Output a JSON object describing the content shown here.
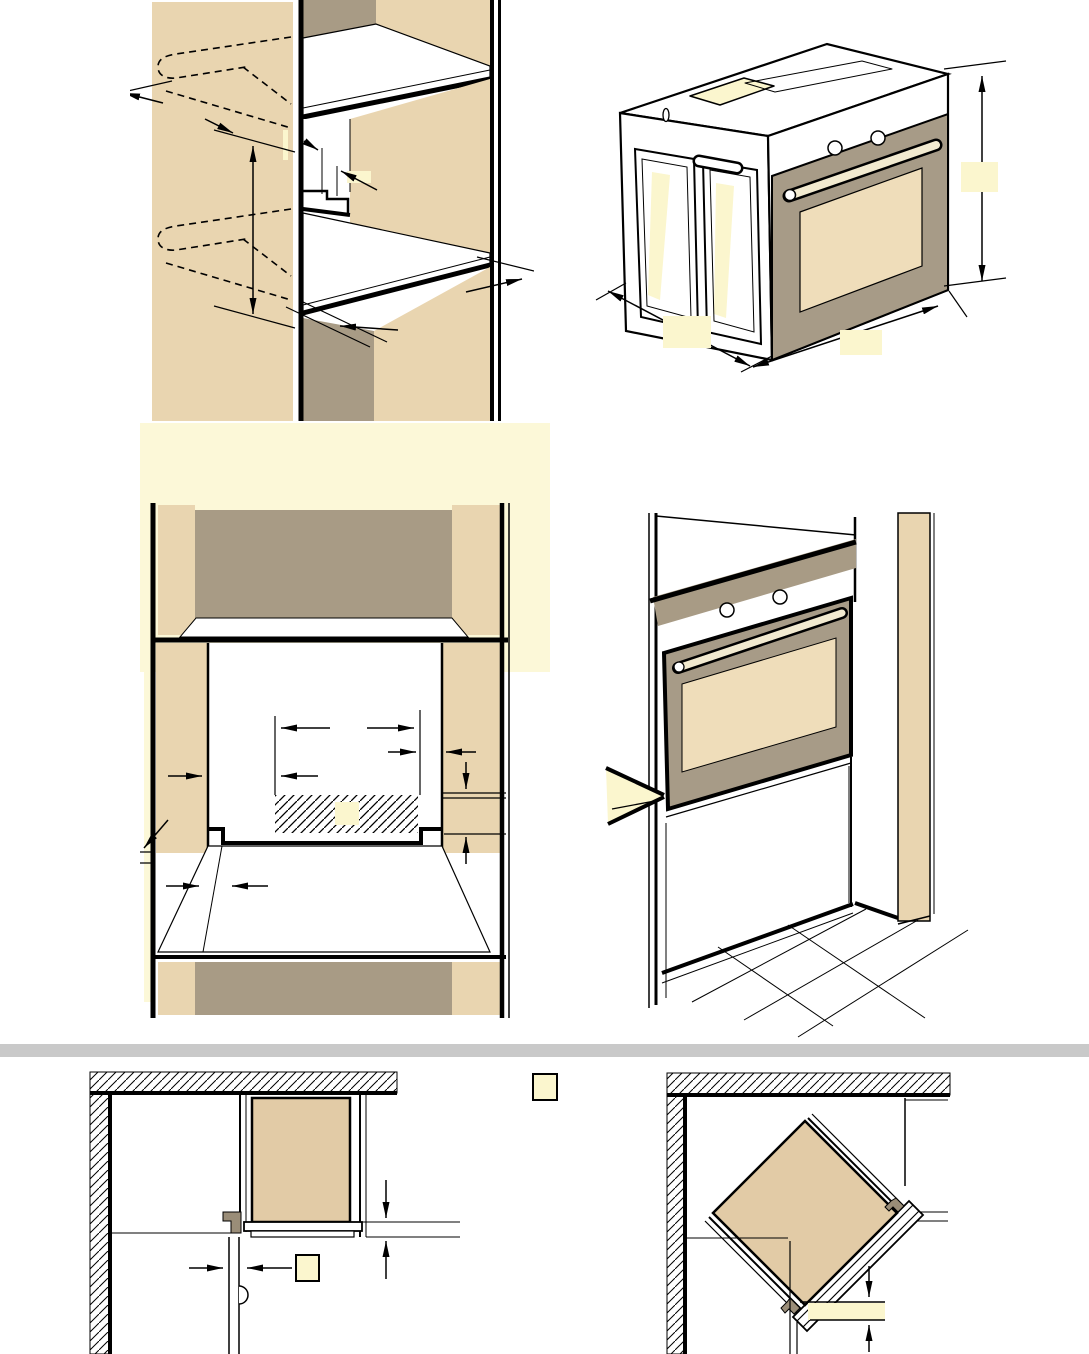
{
  "page": {
    "description": "Built-in oven installation dimension diagrams (manual page, all dimension labels blanked with yellow boxes)",
    "visible_text": "",
    "divider_present": true
  },
  "colors": {
    "page_white": "#ffffff",
    "beige": "#e9d5b0",
    "taupe": "#a89b85",
    "door_taupe": "#a79b87",
    "window_beige": "#efddba",
    "oven_beige": "#e2cba6",
    "bracket": "#9a8d78",
    "cream": "#f2ead0",
    "hl": "#fbf6ce",
    "backdrop": "#fcf8d8",
    "divider": "#c9c9c9",
    "line": "#000000"
  },
  "figures": [
    {
      "id": "shelf-cutout",
      "label": "cabinet-side-panel-cutout-with-shelves",
      "highlight_boxes": 0
    },
    {
      "id": "oven-isometric",
      "label": "oven-isometric-overall-dimensions",
      "highlight_boxes": 3
    },
    {
      "id": "niche-front",
      "label": "niche-front-view-ventilation-cutout",
      "highlight_boxes": 1
    },
    {
      "id": "oven-installed",
      "label": "oven-installed-in-tall-cabinet",
      "highlight_boxes": 0
    },
    {
      "id": "corner-plan",
      "label": "corner-installation-plan-view",
      "highlight_boxes": 2
    },
    {
      "id": "corner-diagonal-plan",
      "label": "diagonal-corner-installation-plan-view",
      "highlight_boxes": 0
    }
  ],
  "highlight_note": "blank-dimension-label-placeholder"
}
